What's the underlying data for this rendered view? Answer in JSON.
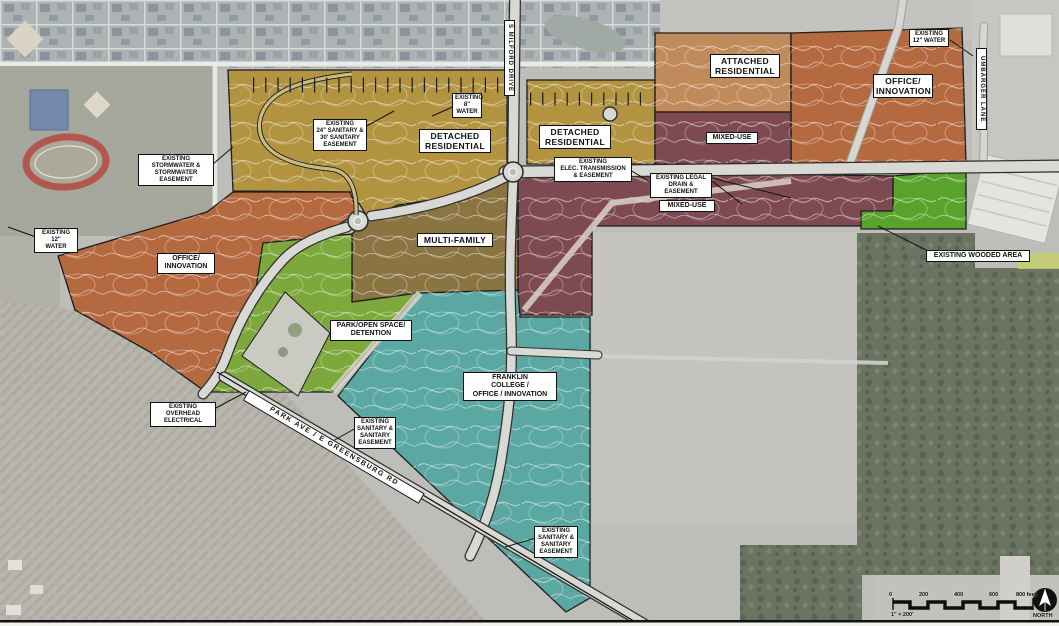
{
  "colors": {
    "detached_residential": "#b29340",
    "attached_residential": "#c08a5a",
    "office_innovation": "#b4693f",
    "mixed_use": "#7e4a52",
    "multi_family": "#8a7442",
    "park_open_space": "#7da83b",
    "existing_wooded": "#59a32c",
    "franklin_college": "#5ba7a1"
  },
  "zones": [
    {
      "name": "detached-residential-west",
      "label": "DETACHED\nRESIDENTIAL"
    },
    {
      "name": "detached-residential-east",
      "label": "DETACHED\nRESIDENTIAL"
    },
    {
      "name": "attached-residential",
      "label": "ATTACHED\nRESIDENTIAL"
    },
    {
      "name": "office-innovation-northeast",
      "label": "OFFICE/\nINNOVATION"
    },
    {
      "name": "mixed-use-north",
      "label": "MIXED-USE"
    },
    {
      "name": "mixed-use-central",
      "label": "MIXED-USE"
    },
    {
      "name": "multi-family",
      "label": "MULTI-FAMILY"
    },
    {
      "name": "office-innovation-west",
      "label": "OFFICE/\nINNOVATION"
    },
    {
      "name": "park-open-space",
      "label": "PARK/OPEN SPACE/\nDETENTION"
    },
    {
      "name": "franklin-college",
      "label": "FRANKLIN\nCOLLEGE /\nOFFICE / INNOVATION"
    },
    {
      "name": "existing-wooded-area",
      "label": "EXISTING WOODED AREA"
    }
  ],
  "callouts": {
    "stormwater": "EXISTING\nSTORMWATER &\nSTORMWATER\nEASEMENT",
    "water12_west": "EXISTING 12\"\nWATER",
    "sanitary24": "EXISTING\n24\" SANITARY &\n30' SANITARY\nEASEMENT",
    "water8": "EXISTING\n8\" WATER",
    "water12_northeast": "EXISTING\n12\" WATER",
    "elec_transmission": "EXISTING\nELEC. TRANSMISSION\n& EASEMENT",
    "legal_drain": "EXISTING LEGAL\nDRAIN & EASEMENT",
    "overhead_electrical": "EXISTING OVERHEAD\nELECTRICAL",
    "sanitary_west": "EXISTING\nSANITARY &\nSANITARY\nEASEMENT",
    "sanitary_south": "EXISTING\nSANITARY &\nSANITARY\nEASEMENT"
  },
  "roads": {
    "s_milford": "S MILFORD DRIVE",
    "umbarger": "UMBARGER LANE",
    "park_ave": "PARK AVE / E GREENSBURG RD"
  },
  "scale_bar": {
    "ticks": [
      "0",
      "200",
      "400",
      "600",
      "800 feet"
    ],
    "ratio": "1\" = 200'",
    "north": "NORTH"
  }
}
